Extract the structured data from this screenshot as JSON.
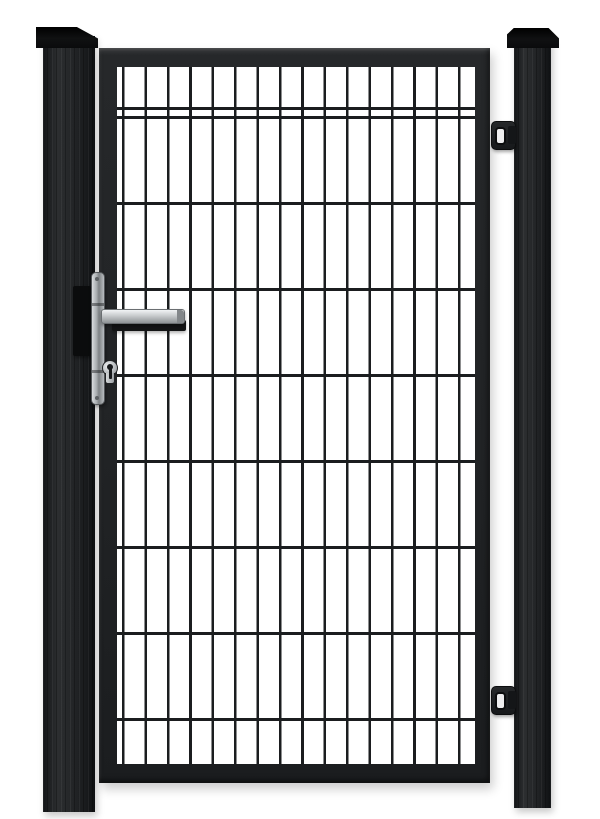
{
  "scene": {
    "type": "product-photo",
    "description": "Single-leaf anthracite metal garden gate with double-wire mesh infill, hung between two square posts with flat caps; silver lever handle with euro cylinder lock on the left stile, two hinges on the right stile.",
    "background_color": "#ffffff"
  },
  "palette": {
    "background": "#ffffff",
    "post": "#212325",
    "post_cap": "#0b0c0d",
    "frame": "#232527",
    "wire": "#1b1d1f",
    "handle_plate_silver": "#b7babd",
    "handle_lever_silver": "#c9ccce",
    "handle_lever_rear_black": "#131415",
    "hinge_body": "#1e2022",
    "hinge_slot_light": "#ededee"
  },
  "mesh": {
    "vertical_wire_count": 16,
    "vertical_spacing_px": 22.4,
    "vertical_wire_width_px": 2.6,
    "vertical_offset_px": 5,
    "horizontal_wire_count": 8,
    "horizontal_spacing_px": 86,
    "horizontal_wire_width_px": 3.2,
    "horizontal_offset_px": 49
  },
  "components": {
    "left_post": "square fence post with flat cap",
    "right_post": "square fence post with flat cap",
    "gate_frame": "welded rectangular gate frame",
    "mesh_panel": "double-wire grid infill panel",
    "handle_unit": "lever handle set with long backplate and euro profile cylinder",
    "hinge_top": "adjustable gate hinge",
    "hinge_bottom": "adjustable gate hinge"
  }
}
